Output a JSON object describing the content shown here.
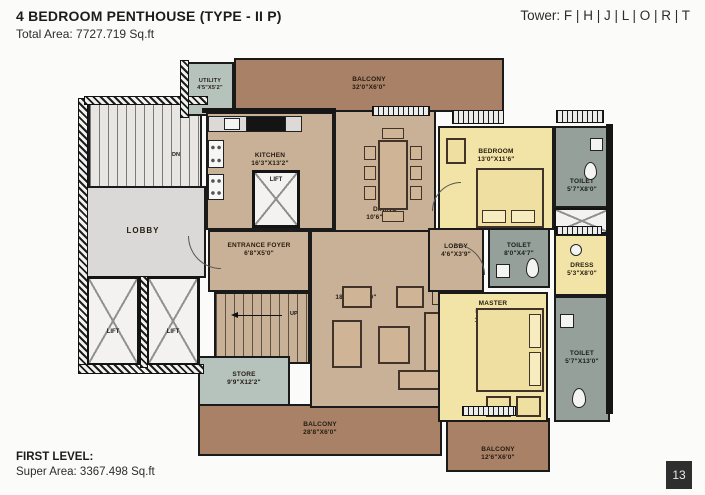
{
  "header": {
    "title": "4 BEDROOM PENTHOUSE (TYPE - II P)",
    "total_area": "Total Area: 7727.719 Sq.ft",
    "tower": "Tower: F | H | J | L | O | R | T"
  },
  "footer": {
    "level_label": "FIRST LEVEL:",
    "super_area": "Super Area: 3367.498 Sq.ft",
    "page_number": "13"
  },
  "colors": {
    "balcony_brown": "#a88166",
    "floor_tan": "#c9b197",
    "bedroom_yellow": "#f2e4a6",
    "toilet_gray": "#96a09a",
    "utility_green": "#b6c3bc",
    "lobby_gray": "#dbd9d7",
    "wall_black": "#1a1a1a",
    "page_box_dark": "#2e2e2e"
  },
  "plan": {
    "rooms": {
      "utility": {
        "name": "UTILITY",
        "dims": "4'5\"X5'2\""
      },
      "balcony_top": {
        "name": "BALCONY",
        "dims": "32'0\"X6'0\""
      },
      "kitchen": {
        "name": "KITCHEN",
        "dims": "16'3\"X13'2\""
      },
      "lift_kitchen": {
        "name": "LIFT"
      },
      "lobby_common": {
        "name": "LOBBY"
      },
      "lift_a": {
        "name": "LIFT"
      },
      "lift_b": {
        "name": "LIFT"
      },
      "entrance_foyer": {
        "name": "ENTRANCE FOYER",
        "dims": "6'8\"X5'0\""
      },
      "dining": {
        "name": "DINING",
        "dims": "10'6\"X14'4\""
      },
      "living": {
        "name": "LIVING",
        "dims": "18'8\"X18'10\""
      },
      "bedroom": {
        "name": "BEDROOM",
        "dims": "13'0\"X11'6\""
      },
      "toilet_bedroom": {
        "name": "TOILET",
        "dims": "5'7\"X8'0\""
      },
      "lobby_internal": {
        "name": "LOBBY",
        "dims": "4'6\"X3'9\""
      },
      "toilet_master_upper": {
        "name": "TOILET",
        "dims": "8'0\"X4'7\""
      },
      "dress": {
        "name": "DRESS",
        "dims": "5'3\"X8'0\""
      },
      "master_bedroom": {
        "name": "MASTER BEDROOM",
        "dims": "11'6\"X17'1\""
      },
      "toilet_master_lower": {
        "name": "TOILET",
        "dims": "5'7\"X13'0\""
      },
      "store": {
        "name": "STORE",
        "dims": "9'9\"X12'2\""
      },
      "balcony_bottom": {
        "name": "BALCONY",
        "dims": "28'8\"X6'0\""
      },
      "balcony_master": {
        "name": "BALCONY",
        "dims": "12'6\"X6'0\""
      }
    },
    "stairs": {
      "up_label": "UP",
      "dn_label": "DN"
    }
  }
}
